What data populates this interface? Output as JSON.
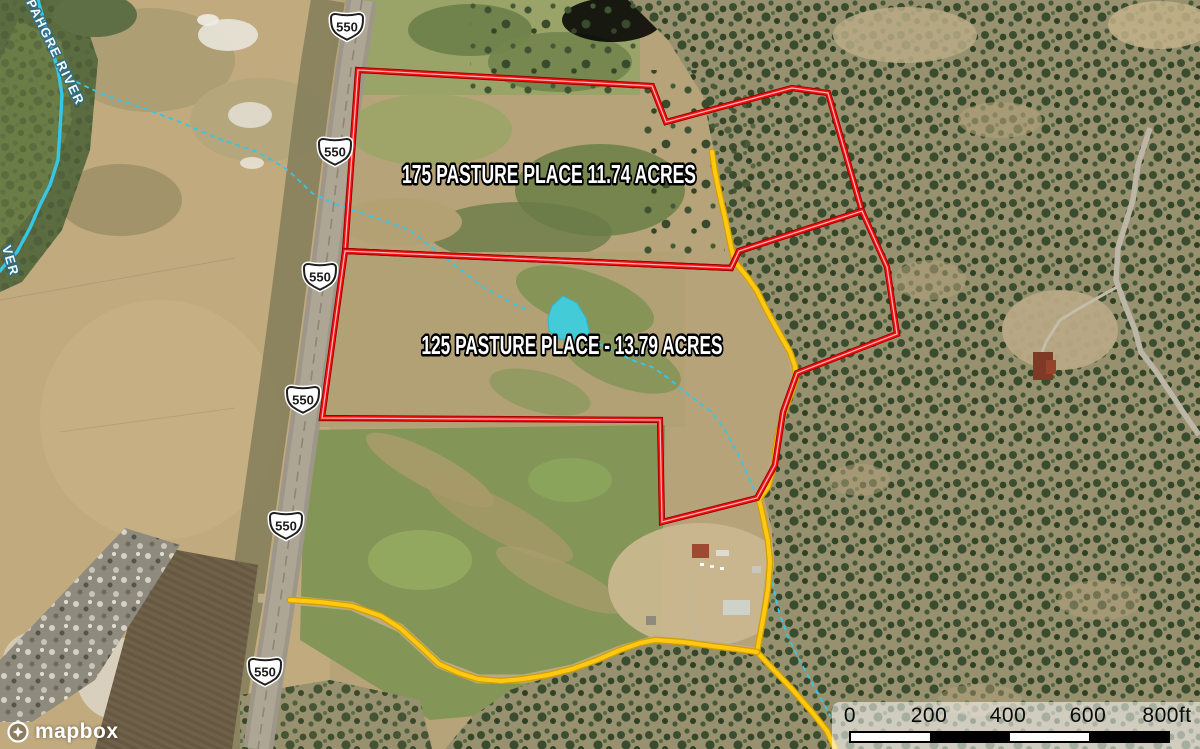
{
  "map": {
    "attribution_text": "mapbox",
    "shield_text": "550",
    "shields": [
      [
        347,
        27
      ],
      [
        335,
        152
      ],
      [
        320,
        277
      ],
      [
        303,
        400
      ],
      [
        286,
        526
      ],
      [
        265,
        672
      ]
    ],
    "river_labels": {
      "upper": {
        "text": "PAHGRE RIVER",
        "pos": [
          26,
          2
        ],
        "angle": 64
      },
      "lower": {
        "text": "VER",
        "pos": [
          2,
          247
        ],
        "angle": 74
      }
    },
    "parcels": [
      {
        "name": "175 PASTURE PLACE 11.74 ACRES",
        "label_pos": [
          549,
          174
        ],
        "label_width": 294,
        "outline": [
          [
            358,
            70
          ],
          [
            652,
            86
          ],
          [
            666,
            122
          ],
          [
            792,
            88
          ],
          [
            828,
            93
          ],
          [
            862,
            211
          ],
          [
            739,
            251
          ],
          [
            731,
            268
          ],
          [
            345,
            251
          ]
        ]
      },
      {
        "name": "125 PASTURE PLACE - 13.79 ACRES",
        "label_pos": [
          572,
          345
        ],
        "label_width": 301,
        "outline": [
          [
            345,
            251
          ],
          [
            731,
            268
          ],
          [
            739,
            251
          ],
          [
            862,
            211
          ],
          [
            887,
            267
          ],
          [
            897,
            334
          ],
          [
            797,
            373
          ],
          [
            783,
            412
          ],
          [
            775,
            465
          ],
          [
            757,
            498
          ],
          [
            662,
            522
          ],
          [
            660,
            420
          ],
          [
            322,
            418
          ]
        ]
      }
    ],
    "roads": [
      {
        "id": "road-north",
        "points": [
          [
            712,
            152
          ],
          [
            715,
            172
          ],
          [
            720,
            196
          ],
          [
            726,
            222
          ],
          [
            731,
            247
          ],
          [
            735,
            262
          ],
          [
            748,
            278
          ],
          [
            757,
            291
          ],
          [
            764,
            305
          ],
          [
            773,
            322
          ],
          [
            782,
            338
          ],
          [
            790,
            352
          ],
          [
            795,
            366
          ],
          [
            796,
            379
          ],
          [
            792,
            391
          ],
          [
            784,
            412
          ],
          [
            778,
            434
          ],
          [
            775,
            452
          ],
          [
            774,
            466
          ],
          [
            768,
            487
          ],
          [
            759,
            499
          ],
          [
            763,
            517
          ],
          [
            768,
            541
          ],
          [
            770,
            562
          ],
          [
            768,
            589
          ],
          [
            764,
            614
          ],
          [
            757,
            652
          ],
          [
            772,
            668
          ],
          [
            792,
            689
          ],
          [
            812,
            712
          ],
          [
            827,
            731
          ],
          [
            835,
            748
          ]
        ]
      },
      {
        "id": "road-west",
        "points": [
          [
            290,
            600
          ],
          [
            320,
            602
          ],
          [
            352,
            606
          ],
          [
            381,
            616
          ],
          [
            400,
            628
          ],
          [
            421,
            647
          ],
          [
            439,
            664
          ],
          [
            459,
            673
          ],
          [
            478,
            679
          ],
          [
            501,
            681
          ],
          [
            523,
            679
          ],
          [
            548,
            675
          ],
          [
            572,
            669
          ],
          [
            597,
            660
          ],
          [
            620,
            650
          ],
          [
            640,
            643
          ],
          [
            655,
            640
          ],
          [
            683,
            642
          ],
          [
            712,
            646
          ],
          [
            736,
            649
          ],
          [
            757,
            652
          ]
        ]
      }
    ],
    "water": {
      "river": [
        [
          38,
          0
        ],
        [
          48,
          36
        ],
        [
          58,
          70
        ],
        [
          62,
          95
        ],
        [
          60,
          130
        ],
        [
          58,
          160
        ],
        [
          50,
          185
        ],
        [
          40,
          205
        ],
        [
          30,
          228
        ],
        [
          17,
          252
        ],
        [
          4,
          266
        ],
        [
          0,
          271
        ]
      ],
      "stream_upper": [
        [
          68,
          78
        ],
        [
          100,
          93
        ],
        [
          140,
          107
        ],
        [
          180,
          122
        ],
        [
          222,
          140
        ],
        [
          258,
          152
        ],
        [
          288,
          170
        ],
        [
          312,
          193
        ],
        [
          335,
          204
        ],
        [
          370,
          216
        ],
        [
          408,
          229
        ],
        [
          448,
          260
        ],
        [
          483,
          287
        ],
        [
          512,
          303
        ],
        [
          530,
          311
        ]
      ],
      "stream_lower": [
        [
          592,
          340
        ],
        [
          607,
          348
        ],
        [
          632,
          360
        ],
        [
          652,
          367
        ],
        [
          668,
          378
        ],
        [
          690,
          396
        ],
        [
          712,
          412
        ],
        [
          725,
          430
        ],
        [
          737,
          452
        ],
        [
          748,
          475
        ],
        [
          757,
          497
        ],
        [
          763,
          520
        ],
        [
          767,
          540
        ],
        [
          769,
          560
        ],
        [
          772,
          580
        ],
        [
          779,
          612
        ],
        [
          788,
          637
        ],
        [
          800,
          661
        ],
        [
          812,
          683
        ],
        [
          824,
          704
        ],
        [
          830,
          716
        ]
      ],
      "pond": [
        [
          563,
          296
        ],
        [
          552,
          306
        ],
        [
          548,
          318
        ],
        [
          549,
          331
        ],
        [
          560,
          339
        ],
        [
          577,
          340
        ],
        [
          590,
          335
        ],
        [
          586,
          318
        ],
        [
          577,
          303
        ]
      ]
    },
    "scale_bar": {
      "labels": [
        "0",
        "200",
        "400",
        "600",
        "800ft"
      ],
      "ticks_px": [
        850,
        929,
        1008,
        1088,
        1167
      ]
    },
    "colors": {
      "parcel_dark": "#8f0000",
      "parcel": "#f20d0d",
      "parcel_core": "#ffb4b4",
      "road_casing": "#d29e00",
      "road": "#ffc913",
      "water": "#35c7e8",
      "pond": "#43ccd8",
      "shield_fill": "#ffffff",
      "shield_stroke": "#1f1f1f"
    }
  }
}
